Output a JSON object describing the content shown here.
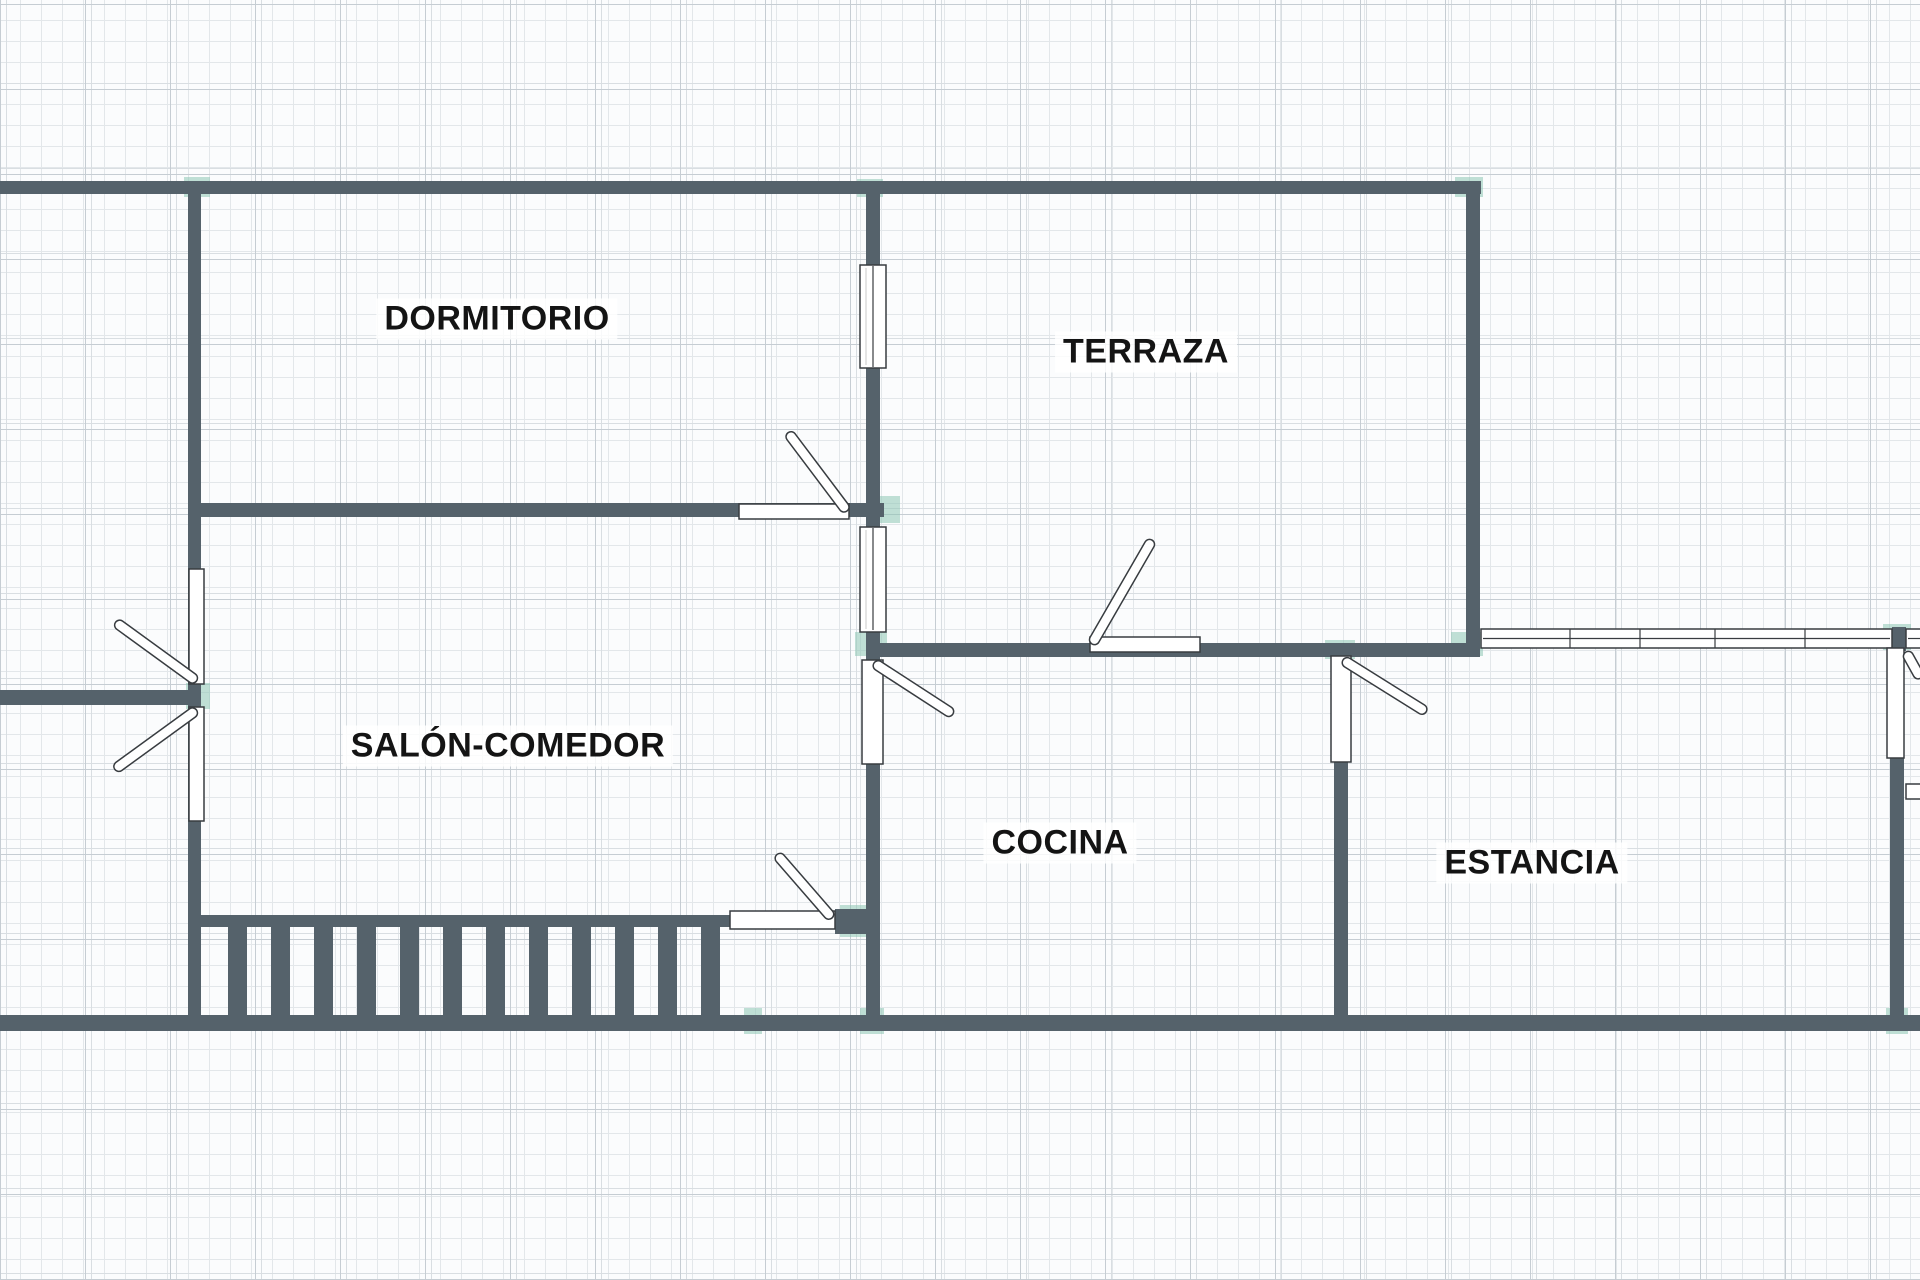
{
  "title": "floor-plan",
  "rooms": [
    {
      "id": "dormitorio",
      "label": "DORMITORIO"
    },
    {
      "id": "terraza",
      "label": "TERRAZA"
    },
    {
      "id": "salon-comedor",
      "label": "SALÓN-COMEDOR"
    },
    {
      "id": "cocina",
      "label": "COCINA"
    },
    {
      "id": "estancia",
      "label": "ESTANCIA"
    }
  ],
  "icons": {
    "door": "door-swing-icon",
    "window": "window-icon",
    "stairs": "stairs-icon"
  },
  "colors": {
    "wall": "#55626b",
    "junction_accent": "#8ec7b5",
    "symbol_outline": "#383c40",
    "label_text": "#141414",
    "background": "#fbfcfd",
    "grid_minor": "#e3e7ea",
    "grid_major": "#c6cdd3"
  }
}
